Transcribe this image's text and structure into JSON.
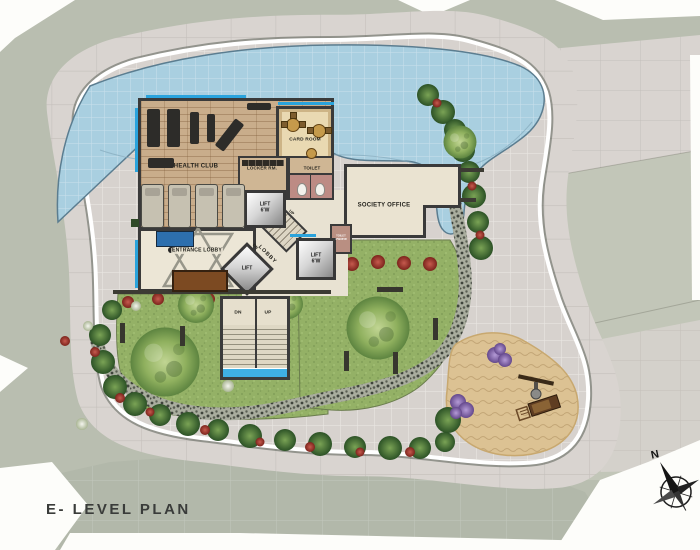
{
  "title": "E- LEVEL PLAN",
  "compass": {
    "north": "N"
  },
  "building": {
    "health_club": "HEALTH CLUB",
    "card_room": "CARD ROOM",
    "locker_rm": "LOCKER RM.",
    "toilet": "TOILET",
    "society_office": "SOCIETY OFFICE",
    "entrance_lobby": "ENTRANCE LOBBY",
    "lobby": "LOBBY",
    "lift": "LIFT",
    "lift_width": "6'W",
    "small_toilet": "TOILET",
    "small_toilet_dims": "4'WX6'W"
  },
  "stairs": {
    "dn": "DN",
    "up": "UP"
  },
  "colors": {
    "pool": "#a9cfe0",
    "lawn": "#93b065",
    "sand": "#dcc293",
    "paving": "#d8d3cf",
    "plaza": "#b2b8aa",
    "wood_floor": "#c9ad8b",
    "accent_blue": "#2aa3dc",
    "wall": "#3a3a3a",
    "flower_red": "#b5443a",
    "flower_purple": "#8a63b8",
    "title_color": "#3a3c3a"
  }
}
